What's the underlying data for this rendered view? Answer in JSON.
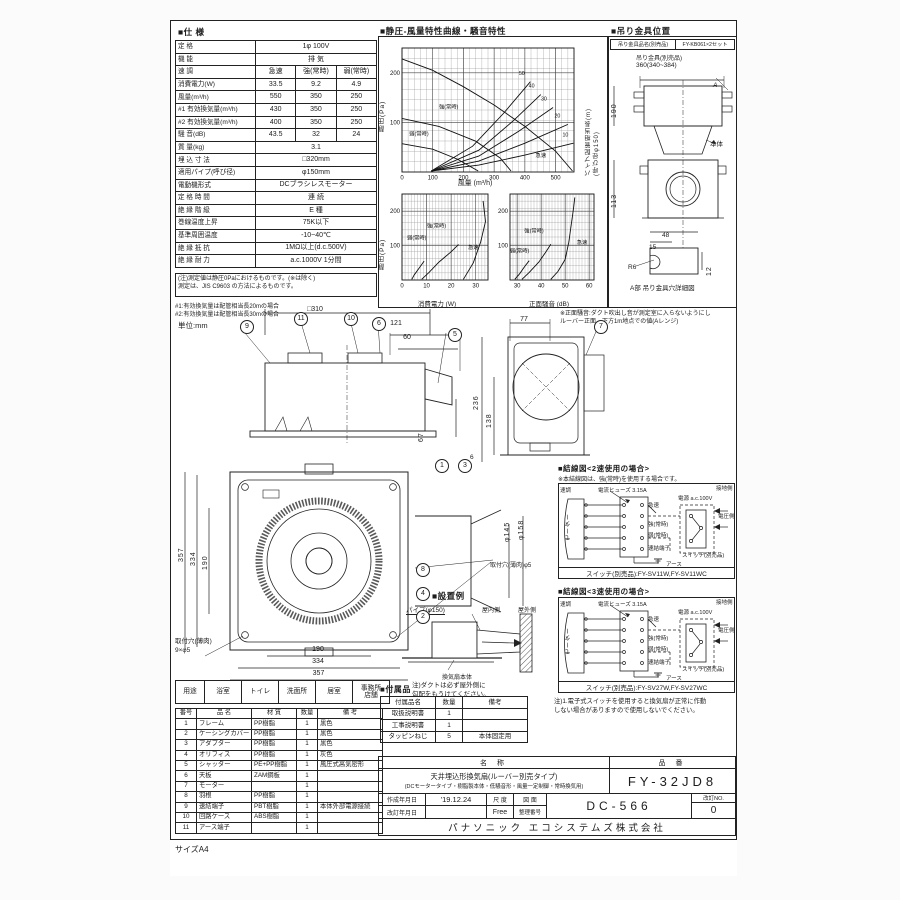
{
  "page": {
    "size_label": "サイズA4",
    "unit_note": "単位:mm"
  },
  "spec": {
    "title": "■仕 様",
    "rows": [
      {
        "label": "定  格",
        "value": "1φ 100V"
      },
      {
        "label": "機  能",
        "value": "排 気"
      },
      {
        "label": "速  調",
        "cells": [
          "急速",
          "強(常時)",
          "弱(常時)"
        ]
      },
      {
        "label": "消費電力(W)",
        "cells": [
          "33.5",
          "9.2",
          "4.9"
        ]
      },
      {
        "label": "風量(m³/h)",
        "cells": [
          "550",
          "350",
          "250"
        ]
      },
      {
        "label": "#1 有効換気量(m³/h)",
        "cells": [
          "430",
          "350",
          "250"
        ]
      },
      {
        "label": "#2 有効換気量(m³/h)",
        "cells": [
          "400",
          "350",
          "250"
        ]
      },
      {
        "label": "騒 音(dB)",
        "cells": [
          "43.5",
          "32",
          "24"
        ]
      },
      {
        "label": "質 量(kg)",
        "value": "3.1"
      },
      {
        "label": "埋 込 寸 法",
        "value": "□320mm"
      },
      {
        "label": "適用パイプ(呼び径)",
        "value": "φ150mm"
      },
      {
        "label": "電動機形式",
        "value": "DCブラシレスモーター"
      },
      {
        "label": "定 格 時 間",
        "value": "連 続"
      },
      {
        "label": "絶 縁 階 級",
        "value": "E 種"
      },
      {
        "label": "巻線温度上昇",
        "value": "75K以下"
      },
      {
        "label": "基準周囲温度",
        "value": "-10~40℃"
      },
      {
        "label": "絶 縁 抵 抗",
        "value": "1MΩ以上(d.c.500V)"
      },
      {
        "label": "絶 縁 耐 力",
        "value": "a.c.1000V 1分間"
      }
    ],
    "note": "(注)測定値は静圧0Paにおけるものです。(※は除く)\n測定は、JIS C9603 の方法によるものです。",
    "footnote1": "#1:有効換気量は配管相当長20mの場合",
    "footnote2": "#2:有効換気量は配管相当長30mの場合"
  },
  "charts": {
    "title": "■静圧-風量特性曲線・騒音特性",
    "xlabel_pq": "風量 (m³/h)",
    "xlabel_power": "消費電力 (W)",
    "xlabel_noise": "正面騒音 (dB)",
    "ylabel": "静圧(Pa)",
    "ylabel2": "静圧(Pa)",
    "right_label": "パイプ配管相当長(m)\n(呼び径φ150)",
    "note": "※正面騒音:ダクト吹出し音が測定室に入らないようにし\nルーバー正面、下方1m地点での値(Aレンジ)"
  },
  "chart_data": [
    {
      "type": "line",
      "title": "静圧-風量特性曲線",
      "xlabel": "風量 (m³/h)",
      "ylabel": "静圧(Pa)",
      "right_label": "パイプ配管相当長(m)(呼び径φ150)",
      "xlim": [
        0,
        560
      ],
      "ylim": [
        0,
        250
      ],
      "xticks": [
        0,
        100,
        200,
        300,
        400,
        500
      ],
      "yticks": [
        100,
        200
      ],
      "grid": true,
      "series": [
        {
          "name": "急速",
          "points": [
            [
              0,
              228
            ],
            [
              100,
              205
            ],
            [
              200,
              172
            ],
            [
              300,
              135
            ],
            [
              400,
              92
            ],
            [
              500,
              42
            ],
            [
              555,
              2
            ]
          ],
          "label_at": [
            452,
            30
          ]
        },
        {
          "name": "強(常時)",
          "points": [
            [
              0,
              108
            ],
            [
              120,
              92
            ],
            [
              240,
              62
            ],
            [
              320,
              28
            ],
            [
              355,
              2
            ]
          ],
          "label_at": [
            152,
            128
          ]
        },
        {
          "name": "弱(常時)",
          "points": [
            [
              0,
              57
            ],
            [
              100,
              46
            ],
            [
              180,
              26
            ],
            [
              248,
              2
            ]
          ],
          "label_at": [
            55,
            74
          ]
        },
        {
          "name": "10",
          "points": [
            [
              95,
              2
            ],
            [
              250,
              14
            ],
            [
              400,
              34
            ],
            [
              558,
              58
            ]
          ],
          "label_at": [
            532,
            72
          ]
        },
        {
          "name": "20",
          "points": [
            [
              95,
              2
            ],
            [
              250,
              22
            ],
            [
              400,
              58
            ],
            [
              540,
              96
            ]
          ],
          "label_at": [
            506,
            110
          ]
        },
        {
          "name": "30",
          "points": [
            [
              95,
              2
            ],
            [
              250,
              32
            ],
            [
              380,
              82
            ],
            [
              492,
              130
            ]
          ],
          "label_at": [
            462,
            144
          ]
        },
        {
          "name": "40",
          "points": [
            [
              95,
              2
            ],
            [
              250,
              44
            ],
            [
              360,
              102
            ],
            [
              452,
              156
            ]
          ],
          "label_at": [
            422,
            170
          ]
        },
        {
          "name": "50",
          "points": [
            [
              95,
              2
            ],
            [
              230,
              52
            ],
            [
              330,
              118
            ],
            [
              418,
              182
            ]
          ],
          "label_at": [
            390,
            196
          ]
        }
      ]
    },
    {
      "type": "line",
      "title": "静圧-消費電力特性",
      "xlabel": "消費電力 (W)",
      "ylabel": "静圧(Pa)",
      "xlim": [
        0,
        35
      ],
      "ylim": [
        0,
        250
      ],
      "xticks": [
        0,
        10,
        20,
        30
      ],
      "yticks": [
        100,
        200
      ],
      "grid": true,
      "series": [
        {
          "name": "急速",
          "points": [
            [
              25,
              2
            ],
            [
              29,
              50
            ],
            [
              32,
              110
            ],
            [
              34,
              170
            ],
            [
              33,
              230
            ]
          ],
          "label_at": [
            29,
            90
          ]
        },
        {
          "name": "強(常時)",
          "points": [
            [
              8,
              2
            ],
            [
              11,
              22
            ],
            [
              15,
              52
            ],
            [
              20,
              82
            ],
            [
              23,
              103
            ]
          ],
          "label_at": [
            14,
            152
          ]
        },
        {
          "name": "弱(常時)",
          "points": [
            [
              4,
              2
            ],
            [
              5,
              15
            ],
            [
              7,
              35
            ],
            [
              9,
              55
            ]
          ],
          "label_at": [
            6,
            118
          ]
        }
      ]
    },
    {
      "type": "line",
      "title": "静圧-正面騒音特性",
      "xlabel": "正面騒音 (dB)",
      "ylabel": "静圧(Pa)",
      "xlim": [
        27,
        62
      ],
      "ylim": [
        0,
        250
      ],
      "xticks": [
        30,
        40,
        50,
        60
      ],
      "yticks": [
        100,
        200
      ],
      "grid": true,
      "series": [
        {
          "name": "急速",
          "points": [
            [
              44,
              2
            ],
            [
              47,
              25
            ],
            [
              50,
              60
            ],
            [
              51.5,
              110
            ],
            [
              52.5,
              160
            ],
            [
              53.5,
              210
            ],
            [
              54,
              240
            ]
          ],
          "label_at": [
            57,
            105
          ]
        },
        {
          "name": "強(常時)",
          "points": [
            [
              32,
              2
            ],
            [
              35,
              22
            ],
            [
              39,
              52
            ],
            [
              42,
              82
            ],
            [
              44,
              104
            ]
          ],
          "label_at": [
            37,
            138
          ]
        },
        {
          "name": "弱(常時)",
          "points": [
            [
              29,
              2
            ],
            [
              31,
              18
            ],
            [
              33,
              38
            ],
            [
              35,
              56
            ]
          ],
          "label_at": [
            31,
            80
          ]
        }
      ]
    }
  ],
  "bracket": {
    "title": "■吊り金具位置",
    "name_label": "吊り金具品名(別売品)",
    "name_value": "FY-KB061×2セット",
    "fitting_label": "吊り金具(別売品)",
    "dim_width": "360(340~384)",
    "dim_height": "190",
    "dim_lower": "113",
    "body_label": "本体",
    "a_label": "A",
    "detail_dims": [
      "48",
      "15",
      "R6",
      "12"
    ],
    "caption": "A部 吊り金具穴詳細図"
  },
  "drawings": {
    "side": {
      "dim_310": "□310",
      "dim_121": "121",
      "dim_60": "60",
      "dim_67": "67",
      "balloons": [
        "9",
        "11",
        "10",
        "6",
        "5"
      ]
    },
    "front": {
      "dim_77": "77",
      "dim_236": "236",
      "dim_138": "138",
      "dim_6": "6",
      "balloon": "7"
    },
    "face": {
      "dim_357l": "357",
      "dim_334l": "334",
      "dim_190l": "190",
      "dim_190b": "190",
      "dim_334b": "334",
      "dim_357b": "357",
      "dim_145": "φ145",
      "dim_158": "φ158",
      "hole_note": "取付穴(薄肉)φ5",
      "hole_note2": "取付穴(薄肉)\n9×φ5",
      "balloons": [
        "1",
        "3",
        "8",
        "4",
        "2"
      ]
    }
  },
  "install": {
    "title": "■設置例",
    "pipe_label": "パイプ(φ150)",
    "indoor": "屋内側",
    "outdoor": "屋外側",
    "body_label": "換気扇本体",
    "note": "注)ダクトは必ず屋外側に\n勾配をもうけてください。"
  },
  "wiring": {
    "title2": "■結線図<2速使用の場合>",
    "note2": "※本結線図は、強(常時)を使用する場合です。",
    "title3": "■結線図<3速使用の場合>",
    "motor": "モーター",
    "speed": "速調",
    "fuse": "電流ヒューズ 3.15A",
    "tap_rapid": "急速",
    "tap_high": "強(常時)",
    "tap_low": "弱(常時)",
    "terminal": "速結端子",
    "power": "電源 a.c.100V",
    "ground_side": "接地側",
    "volt_side": "電圧側",
    "switch_label": "スイッチ(別売品)",
    "earth": "アース",
    "switch2": "スイッチ(別売品):FY-SV11W,FY-SV11WC",
    "switch3": "スイッチ(別売品):FY-SV27W,FY-SV27WC",
    "caution": "注)1.電子式スイッチを使用すると換気扇が正常に作動\nしない場合がありますので使用しないでください。"
  },
  "usage": {
    "header": "用途",
    "items": [
      "浴室",
      "トイレ",
      "洗面所",
      "居室",
      "事務所\n店舗"
    ]
  },
  "parts": {
    "headers": [
      "番号",
      "品  名",
      "材  質",
      "数量",
      "備  考"
    ],
    "rows": [
      [
        "1",
        "フレーム",
        "PP樹脂",
        "1",
        "黒色"
      ],
      [
        "2",
        "ケーシングカバー",
        "PP樹脂",
        "1",
        "黒色"
      ],
      [
        "3",
        "アダプター",
        "PP樹脂",
        "1",
        "黒色"
      ],
      [
        "4",
        "オリフィス",
        "PP樹脂",
        "1",
        "灰色"
      ],
      [
        "5",
        "シャッター",
        "PE+PP樹脂",
        "1",
        "風圧式高気密形"
      ],
      [
        "6",
        "天板",
        "ZAM鋼板",
        "1",
        ""
      ],
      [
        "7",
        "モーター",
        "",
        "1",
        ""
      ],
      [
        "8",
        "羽根",
        "PP樹脂",
        "1",
        ""
      ],
      [
        "9",
        "速結端子",
        "PBT樹脂",
        "1",
        "本体外部電源接続"
      ],
      [
        "10",
        "回路ケース",
        "ABS樹脂",
        "1",
        ""
      ],
      [
        "11",
        "アース端子",
        "",
        "1",
        ""
      ]
    ]
  },
  "accessories": {
    "title": "■付属品",
    "headers": [
      "付属品名",
      "数量",
      "備考"
    ],
    "rows": [
      [
        "取扱説明書",
        "1",
        ""
      ],
      [
        "工事説明書",
        "1",
        ""
      ],
      [
        "タッピンねじ",
        "5",
        "本体固定用"
      ]
    ]
  },
  "titleblock": {
    "name_header": "名  称",
    "model_header": "品  番",
    "name_line1": "天井埋込形換気扇(ルーバー別売タイプ)",
    "name_line2": "(DCモータータイプ・樹脂製本体・低騒音形・風量一定制御・常時換気用)",
    "model": "FY-32JD8",
    "created_label": "作成年月日",
    "created_date": "'19.12.24",
    "revised_label": "改訂年月日",
    "revised_date": "",
    "scale_label": "尺 度",
    "scale_value": "Free",
    "zumen_label": "図 面",
    "seiri_label": "整理番号",
    "drawing_no": "DC-566",
    "rev_label": "改訂NO.",
    "rev_no": "0",
    "company": "パナソニック エコシステムズ株式会社"
  }
}
